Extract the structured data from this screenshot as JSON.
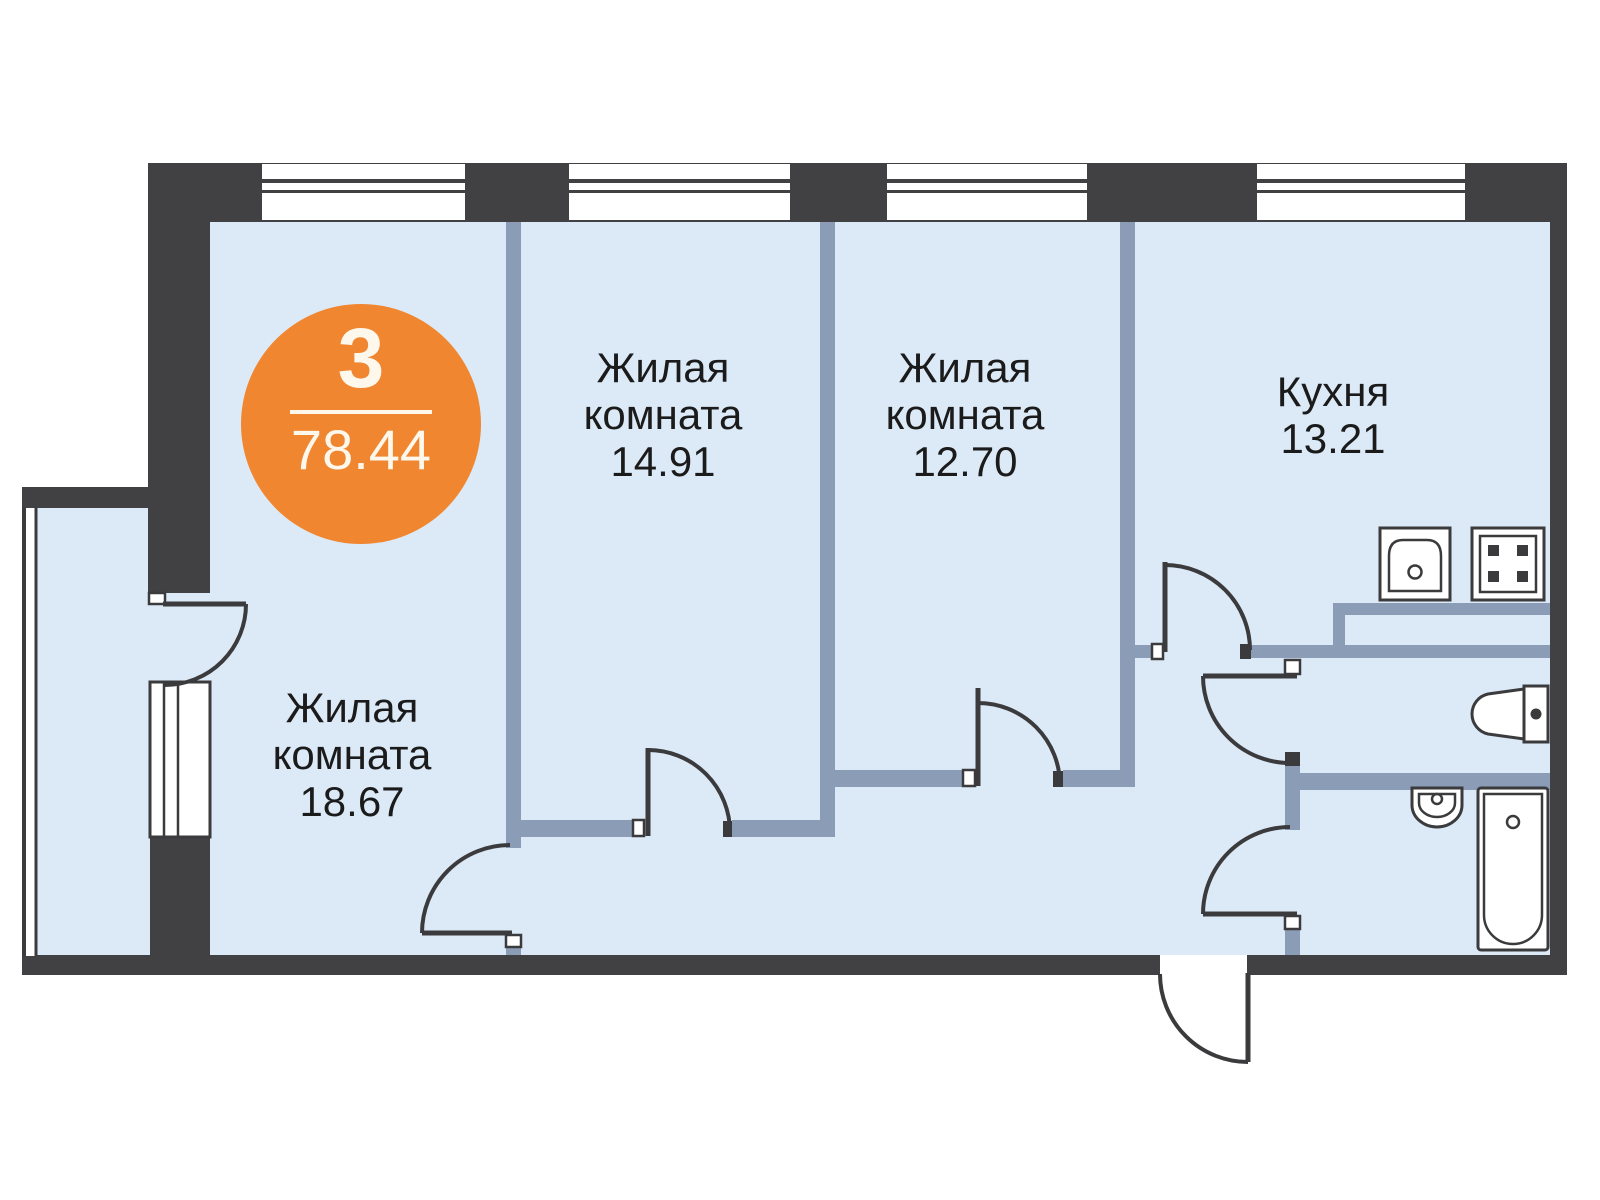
{
  "colors": {
    "exterior_wall": "#414042",
    "partition_wall": "#8b9cb6",
    "floor_fill": "#dceaf7",
    "line": "#3b3b3d",
    "badge_accent": "#f0862f",
    "badge_text": "#fdf7ec",
    "label_text": "#1b1b1b",
    "background": "#ffffff"
  },
  "badge": {
    "rooms_count": "3",
    "total_area": "78.44"
  },
  "rooms": [
    {
      "id": "living-room-1",
      "lines": [
        "Жилая",
        "комната",
        "14.91"
      ]
    },
    {
      "id": "living-room-2",
      "lines": [
        "Жилая",
        "комната",
        "12.70"
      ]
    },
    {
      "id": "kitchen",
      "lines": [
        "Кухня",
        "13.21"
      ]
    },
    {
      "id": "living-room-3",
      "lines": [
        "Жилая",
        "комната",
        "18.67"
      ]
    }
  ],
  "icons": [
    "window-symbol",
    "door-swing-icon",
    "balcony-glazing",
    "kitchen-sink-icon",
    "stove-icon",
    "toilet-icon",
    "washbasin-icon",
    "bathtub-icon",
    "entrance-door-icon"
  ]
}
